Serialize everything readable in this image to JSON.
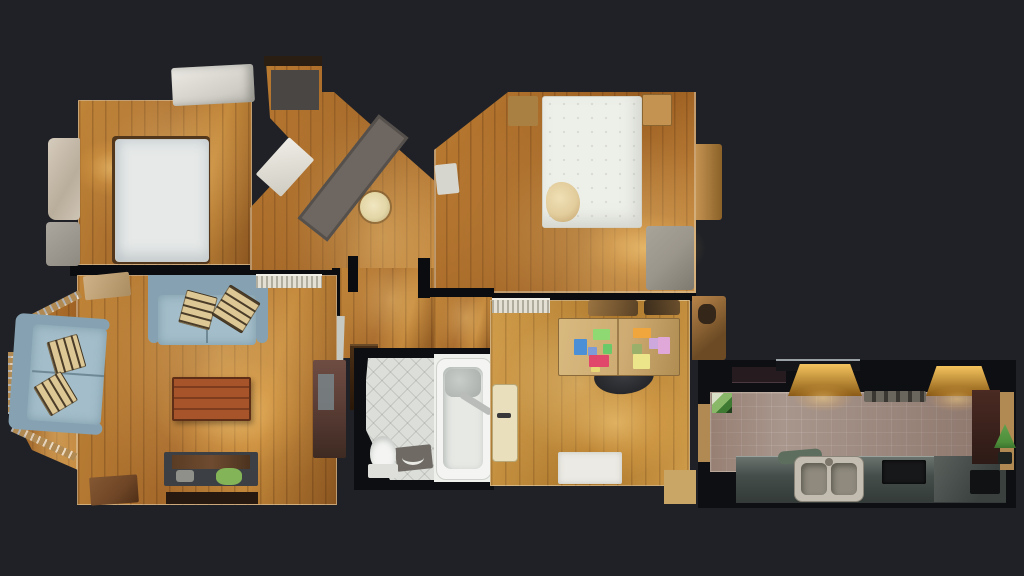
{
  "scene": {
    "type": "3d-dollhouse-floorplan-top-view",
    "description": "Top-down textured 3D scan of an apartment: two bedrooms, hallway, living room, bathroom, office and galley kitchen on a dark background",
    "visible_text": []
  },
  "colors": {
    "bg": "#1f2126",
    "wall": "#0b0c0f",
    "wallLight": "#e8e1cf",
    "woodA1": "#c08538",
    "woodA2": "#a4682a",
    "woodA3": "#8a5520",
    "woodB1": "#bd7e34",
    "woodB2": "#96591d",
    "woodC1": "#cf9c4a",
    "woodC2": "#aa7428",
    "mattress": "#e6e9e8",
    "bedWhite": "#edefe9",
    "bedFrame": "#53371d",
    "pile": "#e2cc9c",
    "wardrobeTan": "#c49352",
    "wardrobeTanDark": "#a97f42",
    "greyUnit": "#9b968b",
    "sofa": "#a3bdca",
    "sofaBack": "#86a2b2",
    "cushion": "#dcc795",
    "cushionMark": "#4a3c28",
    "coffee1": "#a8542b",
    "coffee2": "#7e3c1e",
    "bench": "#3c3f44",
    "benchWood": "#6e4b30",
    "greenObj": "#83b457",
    "cabinet": "#5e4038",
    "cabinetPanel": "#7b8a8e",
    "sideTable": "#6e4526",
    "radiator": "#e4e0d4",
    "radiatorDark": "#b0ac9e",
    "rug": "#6e6761",
    "stool": "#e3d6a6",
    "mat": "#494643",
    "doorDark": "#2a1d12",
    "doorCream": "#e9dfbc",
    "tileBath": "#dcdeda",
    "fixtureWhite": "#f4f5f2",
    "tubInner": "#e7e9e5",
    "chrome": "#b9bcb8",
    "matBath": "#6f6b64",
    "mirror": "#c6c8c2",
    "desk": "#cdab72",
    "chair": "#26272b",
    "paperBlue": "#4b8fd6",
    "paperGreen": "#8fd973",
    "paperBlueViolet": "#7e9bd8",
    "paperGreenSm": "#6cc96a",
    "paperRed": "#e0476a",
    "paperOrange": "#f0a63c",
    "paperOlive": "#9ab06a",
    "paperLilac": "#cda8dd",
    "paperPink": "#e0a8d8",
    "paperYellow": "#ede58a",
    "paperYellowSm": "#e8d878",
    "rugWhite": "#eceae4",
    "closetTab": "#b9854a",
    "connector": "#c9a566",
    "kitchenFloor": "#a8968c",
    "counter1": "#6a736e",
    "counter2": "#333a38",
    "steel": "#c2bdb0",
    "steelBowl": "#8f8a7d",
    "hob": "#17181a",
    "amber1": "#f4c45e",
    "amber2": "#8a5a16",
    "ventA": "#6a665e",
    "ventB": "#3a3732",
    "maroon1": "#4a2a22",
    "maroon2": "#2d1a16",
    "plantGreen": "#4e8f3a",
    "plantPot": "#1e2320",
    "tanStrip": "#b08a52"
  },
  "rooms": [
    {
      "id": "bedroom-1",
      "label": "bedroom-top-left",
      "furniture": [
        "double-mattress",
        "bed-frame",
        "wardrobe-top",
        "closet-clutter"
      ]
    },
    {
      "id": "hallway",
      "label": "entrance-hallway",
      "furniture": [
        "front-door",
        "doormat",
        "runner-rug",
        "round-stool",
        "open-door-leaf"
      ]
    },
    {
      "id": "bedroom-2",
      "label": "bedroom-top-right",
      "furniture": [
        "double-bed",
        "clothes-pile",
        "wardrobe-left",
        "wardrobe-right",
        "grey-unit",
        "side-cabinet",
        "door-tab"
      ]
    },
    {
      "id": "living-room",
      "label": "living-room",
      "furniture": [
        "bay-window",
        "sofa-left",
        "sofa-top",
        "throw-cushions",
        "coffee-table",
        "tv-bench",
        "green-object",
        "tall-cabinet",
        "mirror",
        "radiator",
        "side-table",
        "storage-box"
      ]
    },
    {
      "id": "corridor",
      "label": "central-corridor",
      "furniture": [
        "dark-cabinet",
        "mirror-strip"
      ]
    },
    {
      "id": "bathroom",
      "label": "bathroom",
      "furniture": [
        "toilet",
        "bathtub",
        "bath-mat",
        "shower-screen"
      ]
    },
    {
      "id": "office",
      "label": "office",
      "furniture": [
        "desk",
        "colored-papers",
        "office-chair",
        "radiator",
        "door-leaf",
        "white-rug",
        "closet-tab",
        "shelf-clutter"
      ]
    },
    {
      "id": "kitchen",
      "label": "galley-kitchen",
      "furniture": [
        "worktop-lights",
        "cooker-hood",
        "vent-grill",
        "counter",
        "sink-double-bowl",
        "cutting-board",
        "hob",
        "tall-maroon-unit",
        "plant",
        "window-green"
      ]
    }
  ]
}
